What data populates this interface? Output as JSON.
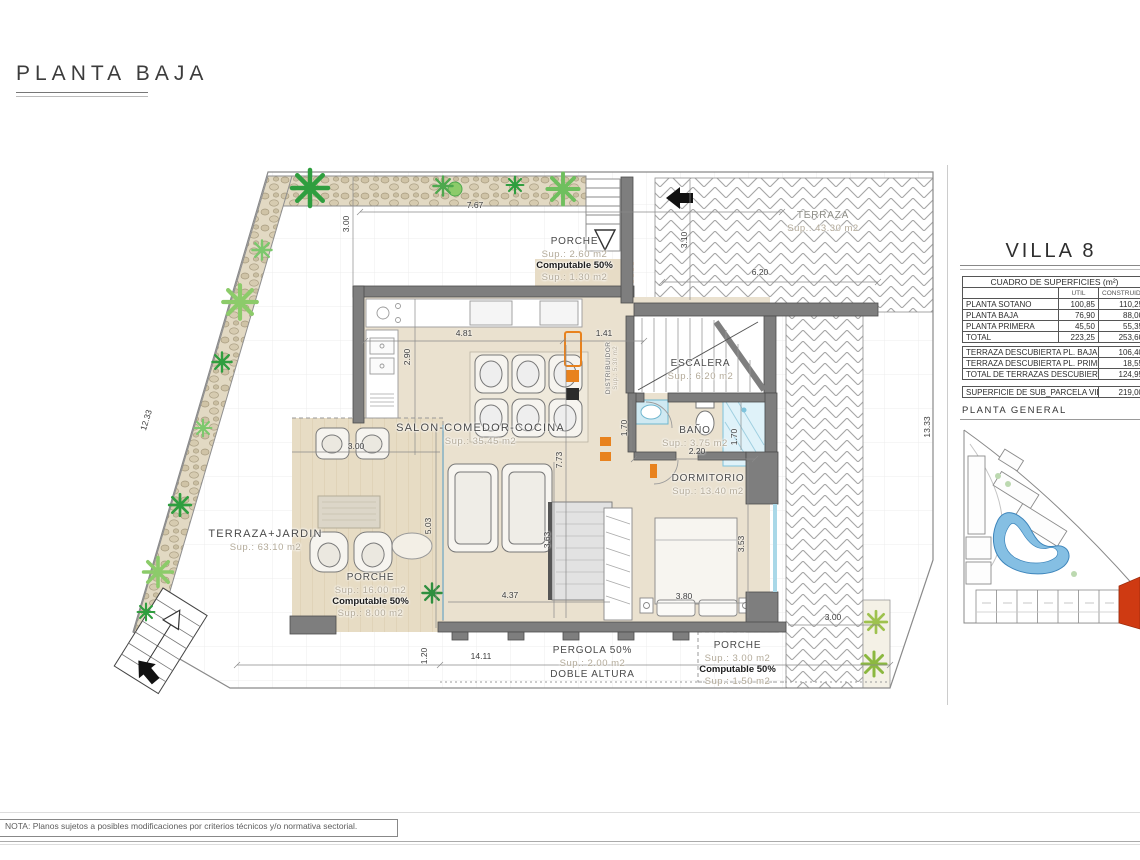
{
  "header": {
    "title": "PLANTA BAJA"
  },
  "panel": {
    "villa_title": "VILLA 8",
    "surfaces": {
      "title": "CUADRO DE SUPERFICIES (m²)",
      "columns": {
        "util": "UTIL",
        "construida": "CONSTRUIDA"
      },
      "rows": [
        {
          "name": "PLANTA SOTANO",
          "util": "100,85",
          "construida": "110,25"
        },
        {
          "name": "PLANTA BAJA",
          "util": "76,90",
          "construida": "88,00"
        },
        {
          "name": "PLANTA PRIMERA",
          "util": "45,50",
          "construida": "55,35"
        },
        {
          "name": "TOTAL",
          "util": "223,25",
          "construida": "253,60"
        }
      ]
    },
    "terraces": {
      "rows": [
        {
          "name": "TERRAZA DESCUBIERTA PL. BAJA",
          "value": "106,40"
        },
        {
          "name": "TERRAZA DESCUBIERTA PL. PRIMERA",
          "value": "18,55"
        },
        {
          "name": "TOTAL DE TERRAZAS DESCUBIERTAS",
          "value": "124,95"
        }
      ]
    },
    "parcel": {
      "name": "SUPERFICIE DE SUB_PARCELA VILLA 8",
      "value": "219,00"
    },
    "planta_general": "PLANTA GENERAL"
  },
  "plan": {
    "rooms": {
      "porche_top": {
        "name": "PORCHE",
        "sup": "Sup.: 2.60 m2",
        "computable": "Computable 50%",
        "sup2": "Sup.: 1.30 m2"
      },
      "salon": {
        "name": "SALON-COMEDOR-COCINA",
        "sup": "Sup.: 35.45 m2"
      },
      "distribuidor": {
        "name": "DISTRIBUIDOR",
        "sup": "Sup.: 5.30 m2"
      },
      "escalera": {
        "name": "ESCALERA",
        "sup": "Sup.: 6.20 m2"
      },
      "bano": {
        "name": "BAÑO",
        "sup": "Sup.: 3.75 m2"
      },
      "dormitorio": {
        "name": "DORMITORIO",
        "sup": "Sup.: 13.40 m2"
      },
      "terraza_jardin": {
        "name": "TERRAZA+JARDIN",
        "sup": "Sup.: 63.10 m2"
      },
      "porche_main": {
        "name": "PORCHE",
        "sup": "Sup.: 16.00 m2",
        "computable": "Computable 50%",
        "sup2": "Sup.: 8.00 m2"
      },
      "pergola": {
        "name": "PERGOLA 50%",
        "sup": "Sup.: 2.00 m2",
        "extra": "DOBLE ALTURA"
      },
      "porche_br": {
        "name": "PORCHE",
        "sup": "Sup.: 3.00 m2",
        "computable": "Computable 50%",
        "sup2": "Sup.: 1.50 m2"
      },
      "terraza_top": {
        "name": "TERRAZA",
        "sup": "Sup.: 43.30 m2"
      }
    },
    "dimensions": {
      "d767": "7.67",
      "d300tl": "3.00",
      "d1233": "12.33",
      "d310": "3.10",
      "d620": "6.20",
      "d481": "4.81",
      "d141": "1.41",
      "d290": "2.90",
      "d773": "7.73",
      "d170l": "1.70",
      "d220": "2.20",
      "d170r": "1.70",
      "d363": "3.63",
      "d353": "3.53",
      "d380": "3.80",
      "d437": "4.37",
      "d300p": "3.00",
      "d503": "5.03",
      "d1333": "13.33",
      "d1411": "14.11",
      "d120": "1.20",
      "d300br": "3.00"
    }
  },
  "note": {
    "text": "NOTA: Planos sujetos a posibles modificaciones por criterios técnicos y/o normativa sectorial."
  },
  "colors": {
    "accent_red": "#cf3a12",
    "pool_blue": "#85bfe3",
    "orange": "#e8821e",
    "wall_gray": "#7e7e7e"
  }
}
